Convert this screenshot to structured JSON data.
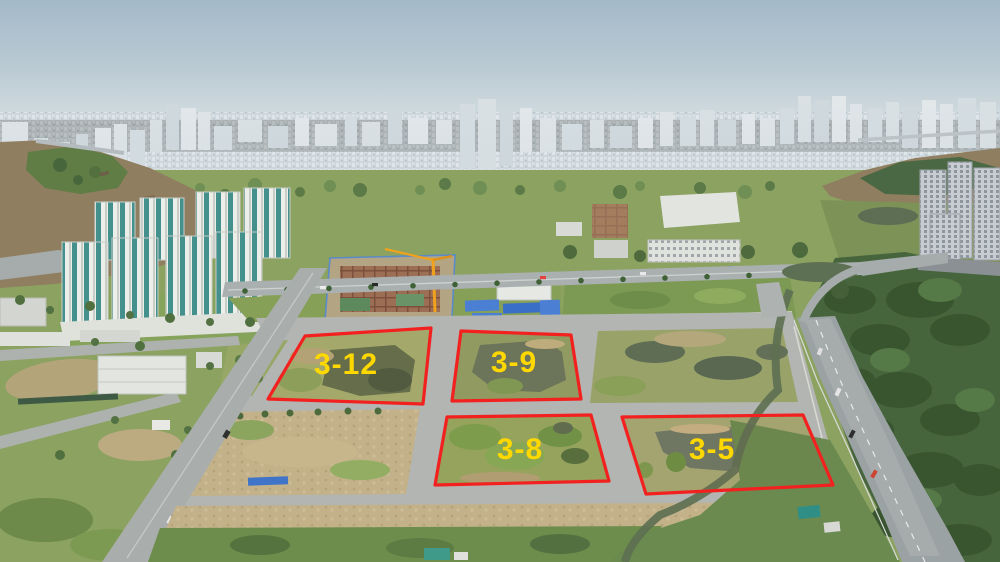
{
  "annotations": {
    "outline_color": "#f32020",
    "label_color": "#ffd800",
    "plots": [
      {
        "id": "3-12",
        "label": "3-12",
        "points": "305,336 431,328 423,404 268,399",
        "label_x": 346,
        "label_y": 374
      },
      {
        "id": "3-9",
        "label": "3-9",
        "points": "461,331 571,335 581,399 452,401",
        "label_x": 514,
        "label_y": 372
      },
      {
        "id": "3-8",
        "label": "3-8",
        "points": "447,417 591,415 609,481 435,485",
        "label_x": 520,
        "label_y": 459
      },
      {
        "id": "3-5",
        "label": "3-5",
        "points": "622,417 803,415 833,485 646,494",
        "label_x": 712,
        "label_y": 459
      }
    ]
  }
}
